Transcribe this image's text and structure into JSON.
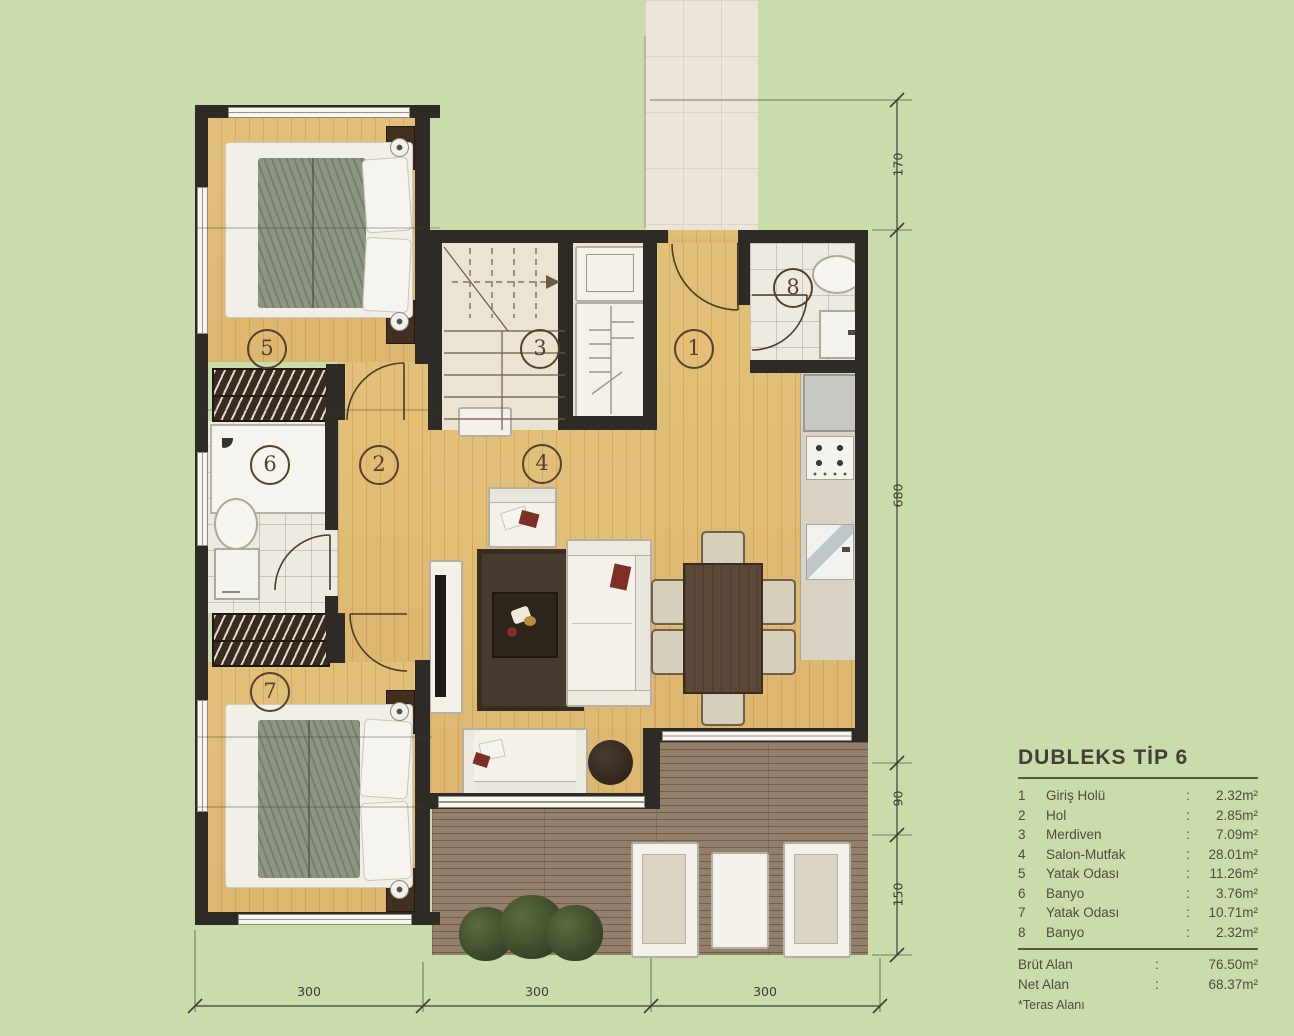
{
  "legend": {
    "title": "DUBLEKS TİP 6",
    "colon": ":",
    "rooms": [
      {
        "num": "1",
        "name": "Giriş Holü",
        "area": "2.32m²"
      },
      {
        "num": "2",
        "name": "Hol",
        "area": "2.85m²"
      },
      {
        "num": "3",
        "name": "Merdiven",
        "area": "7.09m²"
      },
      {
        "num": "4",
        "name": "Salon-Mutfak",
        "area": "28.01m²"
      },
      {
        "num": "5",
        "name": "Yatak Odası",
        "area": "11.26m²"
      },
      {
        "num": "6",
        "name": "Banyo",
        "area": "3.76m²"
      },
      {
        "num": "7",
        "name": "Yatak Odası",
        "area": "10.71m²"
      },
      {
        "num": "8",
        "name": "Banyo",
        "area": "2.32m²"
      }
    ],
    "totals": [
      {
        "label": "Brüt Alan",
        "value": "76.50m²"
      },
      {
        "label": "Net Alan",
        "value": "68.37m²"
      }
    ],
    "note": "*Teras Alanı"
  },
  "plan": {
    "room_labels": [
      "1",
      "2",
      "3",
      "4",
      "5",
      "6",
      "7",
      "8"
    ],
    "dimensions": {
      "right": [
        "170",
        "680",
        "90",
        "150"
      ],
      "bottom": [
        "300",
        "300",
        "300"
      ]
    }
  },
  "colors": {
    "background": "#cbdcab",
    "wall": "#2e2b26",
    "wood_floor": "#e1bd76",
    "terrace_deck": "#93806a",
    "annotation": "#53412c"
  }
}
